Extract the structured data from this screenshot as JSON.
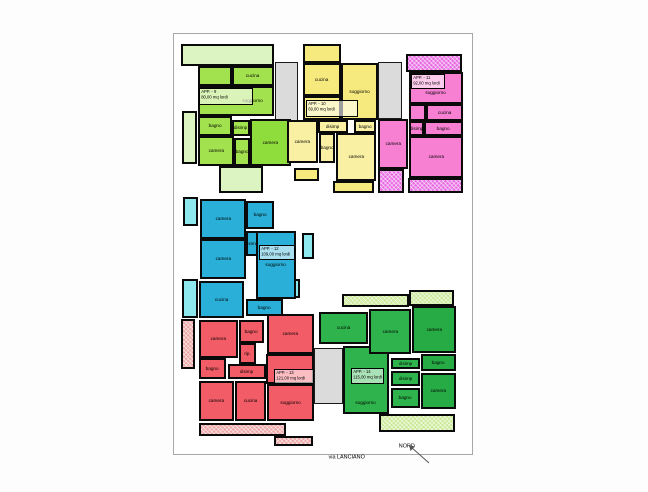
{
  "annotations": {
    "street": "via LANCIANO",
    "north": "NORD"
  },
  "palette": {
    "stairwell": "#dbdbdb",
    "wall": "#0a0a0a",
    "page_border": "#a8a8a8"
  },
  "stairwells": [
    {
      "x": 101,
      "y": 28,
      "w": 23,
      "h": 86
    },
    {
      "x": 204,
      "y": 28,
      "w": 24,
      "h": 57
    },
    {
      "x": 140,
      "y": 314,
      "w": 29,
      "h": 56
    }
  ],
  "apartments": [
    {
      "id": "app-9",
      "label": "APP. - 9",
      "area": "80,00 mq lordi",
      "colors": {
        "main": "#a3e24f",
        "alt": "#8fdc3d",
        "pale": "#dcf4c2",
        "hatch": "#dcf4c2"
      },
      "label_box": {
        "x": 25,
        "y": 54,
        "w": 54,
        "h": 17
      },
      "rooms": [
        {
          "x": 7,
          "y": 10,
          "w": 93,
          "h": 22,
          "label": "",
          "shade": "pale"
        },
        {
          "x": 8,
          "y": 77,
          "w": 15,
          "h": 53,
          "label": "",
          "shade": "pale"
        },
        {
          "x": 45,
          "y": 132,
          "w": 44,
          "h": 27,
          "label": "",
          "shade": "pale"
        },
        {
          "x": 24,
          "y": 32,
          "w": 34,
          "h": 20,
          "label": "",
          "shade": "main"
        },
        {
          "x": 58,
          "y": 32,
          "w": 42,
          "h": 20,
          "label": "cucina",
          "shade": "main"
        },
        {
          "x": 24,
          "y": 52,
          "w": 76,
          "h": 30,
          "label": "soggiorno",
          "shade": "main",
          "la": "r"
        },
        {
          "x": 24,
          "y": 82,
          "w": 34,
          "h": 20,
          "label": "bagno",
          "shade": "main"
        },
        {
          "x": 58,
          "y": 86,
          "w": 18,
          "h": 16,
          "label": "disimp",
          "shade": "main"
        },
        {
          "x": 24,
          "y": 102,
          "w": 36,
          "h": 30,
          "label": "camera",
          "shade": "main"
        },
        {
          "x": 60,
          "y": 104,
          "w": 16,
          "h": 28,
          "label": "bagno",
          "shade": "main"
        },
        {
          "x": 76,
          "y": 85,
          "w": 41,
          "h": 47,
          "label": "camera",
          "shade": "alt"
        }
      ]
    },
    {
      "id": "app-10",
      "label": "APP. - 10",
      "area": "69,00 mq lordi",
      "colors": {
        "main": "#f6ea7e",
        "alt": "#f6ea7e",
        "pale": "#f9f0a3",
        "hatch": "#f9f0a3"
      },
      "label_box": {
        "x": 132,
        "y": 66,
        "w": 52,
        "h": 17
      },
      "rooms": [
        {
          "x": 129,
          "y": 10,
          "w": 38,
          "h": 19,
          "label": "",
          "shade": "main"
        },
        {
          "x": 129,
          "y": 29,
          "w": 38,
          "h": 33,
          "label": "cucina",
          "shade": "main"
        },
        {
          "x": 167,
          "y": 29,
          "w": 37,
          "h": 57,
          "label": "soggiorno",
          "shade": "main"
        },
        {
          "x": 129,
          "y": 62,
          "w": 38,
          "h": 24,
          "label": "",
          "shade": "main"
        },
        {
          "x": 144,
          "y": 86,
          "w": 30,
          "h": 13,
          "label": "disimp",
          "shade": "pale"
        },
        {
          "x": 180,
          "y": 86,
          "w": 22,
          "h": 13,
          "label": "bagno",
          "shade": "pale"
        },
        {
          "x": 113,
          "y": 86,
          "w": 31,
          "h": 43,
          "label": "camera",
          "shade": "pale"
        },
        {
          "x": 145,
          "y": 99,
          "w": 16,
          "h": 30,
          "label": "bagno",
          "shade": "pale"
        },
        {
          "x": 162,
          "y": 99,
          "w": 40,
          "h": 48,
          "label": "camera",
          "shade": "pale"
        },
        {
          "x": 120,
          "y": 134,
          "w": 25,
          "h": 13,
          "label": "",
          "shade": "main"
        },
        {
          "x": 159,
          "y": 147,
          "w": 41,
          "h": 12,
          "label": "",
          "shade": "main"
        }
      ]
    },
    {
      "id": "app-11",
      "label": "APP. - 11",
      "area": "92,00 mq lordi",
      "colors": {
        "main": "#f780d3",
        "alt": "#f780d3",
        "pale": "#f9a5df",
        "hatch": "#e868e2"
      },
      "label_box": {
        "x": 237,
        "y": 40,
        "w": 34,
        "h": 15
      },
      "rooms": [
        {
          "x": 232,
          "y": 20,
          "w": 56,
          "h": 18,
          "label": "",
          "shade": "hatch"
        },
        {
          "x": 235,
          "y": 38,
          "w": 54,
          "h": 32,
          "label": "soggiorno",
          "shade": "main",
          "la": "b"
        },
        {
          "x": 235,
          "y": 70,
          "w": 17,
          "h": 17,
          "label": "",
          "shade": "main"
        },
        {
          "x": 252,
          "y": 70,
          "w": 37,
          "h": 17,
          "label": "cucina",
          "shade": "main"
        },
        {
          "x": 235,
          "y": 87,
          "w": 15,
          "h": 15,
          "label": "disimp",
          "shade": "main"
        },
        {
          "x": 250,
          "y": 87,
          "w": 39,
          "h": 15,
          "label": "bagno",
          "shade": "main"
        },
        {
          "x": 204,
          "y": 85,
          "w": 30,
          "h": 50,
          "label": "camera",
          "shade": "main"
        },
        {
          "x": 235,
          "y": 102,
          "w": 54,
          "h": 42,
          "label": "camera",
          "shade": "main"
        },
        {
          "x": 204,
          "y": 135,
          "w": 26,
          "h": 24,
          "label": "",
          "shade": "hatch"
        },
        {
          "x": 234,
          "y": 144,
          "w": 55,
          "h": 15,
          "label": "",
          "shade": "hatch"
        }
      ]
    },
    {
      "id": "app-12",
      "label": "APP. - 12",
      "area": "109,00 mq lordi",
      "colors": {
        "main": "#2ab0d8",
        "alt": "#2ab0d8",
        "pale": "#8ee9ef",
        "hatch": "#8ee9ef"
      },
      "label_box": {
        "x": 85,
        "y": 211,
        "w": 36,
        "h": 15
      },
      "rooms": [
        {
          "x": 9,
          "y": 163,
          "w": 15,
          "h": 29,
          "label": "",
          "shade": "pale"
        },
        {
          "x": 8,
          "y": 245,
          "w": 16,
          "h": 39,
          "label": "",
          "shade": "pale"
        },
        {
          "x": 128,
          "y": 199,
          "w": 12,
          "h": 26,
          "label": "",
          "shade": "pale"
        },
        {
          "x": 110,
          "y": 245,
          "w": 16,
          "h": 19,
          "label": "",
          "shade": "pale"
        },
        {
          "x": 26,
          "y": 165,
          "w": 46,
          "h": 40,
          "label": "camera",
          "shade": "main"
        },
        {
          "x": 72,
          "y": 167,
          "w": 28,
          "h": 28,
          "label": "bagno",
          "shade": "main"
        },
        {
          "x": 72,
          "y": 197,
          "w": 12,
          "h": 25,
          "label": "disimp",
          "shade": "main"
        },
        {
          "x": 82,
          "y": 197,
          "w": 40,
          "h": 68,
          "label": "soggiorno",
          "shade": "main"
        },
        {
          "x": 26,
          "y": 205,
          "w": 46,
          "h": 40,
          "label": "camera",
          "shade": "main"
        },
        {
          "x": 25,
          "y": 247,
          "w": 45,
          "h": 37,
          "label": "cucina",
          "shade": "main"
        },
        {
          "x": 72,
          "y": 265,
          "w": 37,
          "h": 17,
          "label": "bagno",
          "shade": "main"
        }
      ]
    },
    {
      "id": "app-13",
      "label": "APP. - 13",
      "area": "121,00 mq lordi",
      "colors": {
        "main": "#f25c66",
        "alt": "#f25c66",
        "pale": "#eca5a4",
        "hatch": "#eca5a4"
      },
      "label_box": {
        "x": 100,
        "y": 335,
        "w": 40,
        "h": 15
      },
      "rooms": [
        {
          "x": 7,
          "y": 285,
          "w": 14,
          "h": 50,
          "label": "",
          "shade": "hatch"
        },
        {
          "x": 25,
          "y": 286,
          "w": 39,
          "h": 38,
          "label": "camera",
          "shade": "main"
        },
        {
          "x": 65,
          "y": 286,
          "w": 25,
          "h": 23,
          "label": "bagno",
          "shade": "main"
        },
        {
          "x": 93,
          "y": 280,
          "w": 47,
          "h": 40,
          "label": "camera",
          "shade": "main"
        },
        {
          "x": 65,
          "y": 309,
          "w": 17,
          "h": 21,
          "label": "rip.",
          "shade": "main"
        },
        {
          "x": 25,
          "y": 324,
          "w": 27,
          "h": 21,
          "label": "bagno",
          "shade": "main"
        },
        {
          "x": 54,
          "y": 330,
          "w": 38,
          "h": 15,
          "label": "disimp",
          "shade": "main"
        },
        {
          "x": 92,
          "y": 320,
          "w": 48,
          "h": 30,
          "label": "",
          "shade": "main"
        },
        {
          "x": 25,
          "y": 347,
          "w": 35,
          "h": 40,
          "label": "camera",
          "shade": "main"
        },
        {
          "x": 61,
          "y": 347,
          "w": 31,
          "h": 40,
          "label": "cucina",
          "shade": "main"
        },
        {
          "x": 93,
          "y": 350,
          "w": 47,
          "h": 37,
          "label": "soggiorno",
          "shade": "main"
        },
        {
          "x": 25,
          "y": 389,
          "w": 87,
          "h": 13,
          "label": "",
          "shade": "hatch"
        },
        {
          "x": 100,
          "y": 402,
          "w": 39,
          "h": 10,
          "label": "",
          "shade": "hatch"
        }
      ]
    },
    {
      "id": "app-14",
      "label": "APP. - 14",
      "area": "115,00 mq lordi",
      "colors": {
        "main": "#2fb44d",
        "alt": "#27ac45",
        "pale": "#c9e996",
        "hatch": "#c9e996"
      },
      "label_box": {
        "x": 177,
        "y": 334,
        "w": 33,
        "h": 16
      },
      "rooms": [
        {
          "x": 168,
          "y": 260,
          "w": 67,
          "h": 13,
          "label": "",
          "shade": "hatch"
        },
        {
          "x": 235,
          "y": 256,
          "w": 45,
          "h": 16,
          "label": "",
          "shade": "hatch"
        },
        {
          "x": 145,
          "y": 278,
          "w": 49,
          "h": 32,
          "label": "cucina",
          "shade": "main"
        },
        {
          "x": 169,
          "y": 312,
          "w": 46,
          "h": 68,
          "label": "soggiorno",
          "shade": "main",
          "la": "b"
        },
        {
          "x": 195,
          "y": 275,
          "w": 42,
          "h": 45,
          "label": "camera",
          "shade": "main"
        },
        {
          "x": 238,
          "y": 272,
          "w": 44,
          "h": 47,
          "label": "camera",
          "shade": "alt"
        },
        {
          "x": 217,
          "y": 324,
          "w": 29,
          "h": 11,
          "label": "disimp",
          "shade": "main"
        },
        {
          "x": 247,
          "y": 320,
          "w": 35,
          "h": 17,
          "label": "bagno",
          "shade": "alt"
        },
        {
          "x": 217,
          "y": 337,
          "w": 29,
          "h": 15,
          "label": "disimp",
          "shade": "main"
        },
        {
          "x": 217,
          "y": 354,
          "w": 29,
          "h": 20,
          "label": "bagno",
          "shade": "main"
        },
        {
          "x": 247,
          "y": 339,
          "w": 35,
          "h": 36,
          "label": "camera",
          "shade": "alt"
        },
        {
          "x": 205,
          "y": 380,
          "w": 76,
          "h": 18,
          "label": "",
          "shade": "hatch"
        }
      ]
    }
  ]
}
